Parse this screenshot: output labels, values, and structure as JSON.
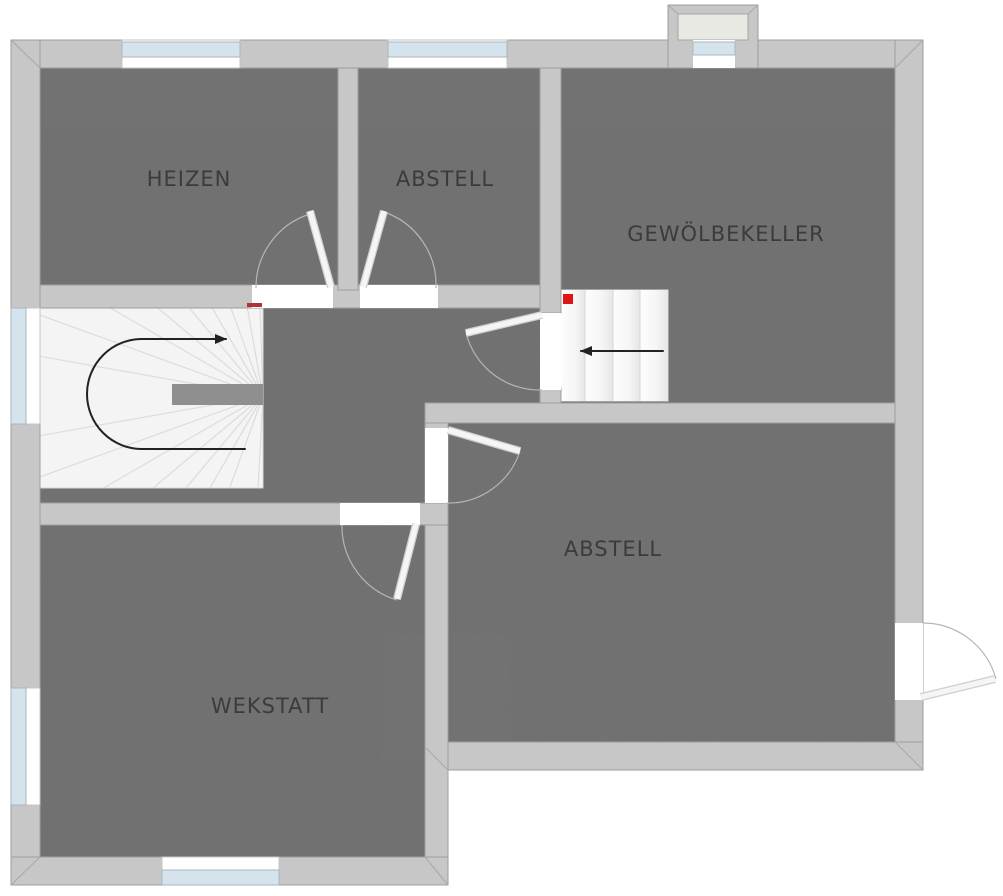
{
  "plan": {
    "rooms": [
      {
        "id": "heizen",
        "label": "HEIZEN"
      },
      {
        "id": "abstell-top",
        "label": "ABSTELL"
      },
      {
        "id": "gewoelbekeller",
        "label": "GEWÖLBEKELLER"
      },
      {
        "id": "abstell-right",
        "label": "ABSTELL"
      },
      {
        "id": "wekstatt",
        "label": "WEKSTATT"
      }
    ],
    "stairs": [
      {
        "id": "winder-stair",
        "arrow": "u-turn-right"
      },
      {
        "id": "straight-stair",
        "arrow": "left"
      }
    ],
    "markers": [
      {
        "id": "stair-marker-left",
        "color": "#b03434"
      },
      {
        "id": "stair-marker-right",
        "color": "#e01414"
      }
    ],
    "colors": {
      "background": "#ffffff",
      "floor": "#929292",
      "wall": "#c7c7c7",
      "wall_outline": "#9e9e9e",
      "window_glass": "#d5e4ec",
      "stair_tread": "#f4f4f4",
      "door_arc": "#b5b5b5",
      "arrow": "#222222",
      "marker_red": "#e01414",
      "marker_dark_red": "#b03434",
      "chimney_inner": "#e9e9e4",
      "label": "#3b3b3b"
    }
  }
}
